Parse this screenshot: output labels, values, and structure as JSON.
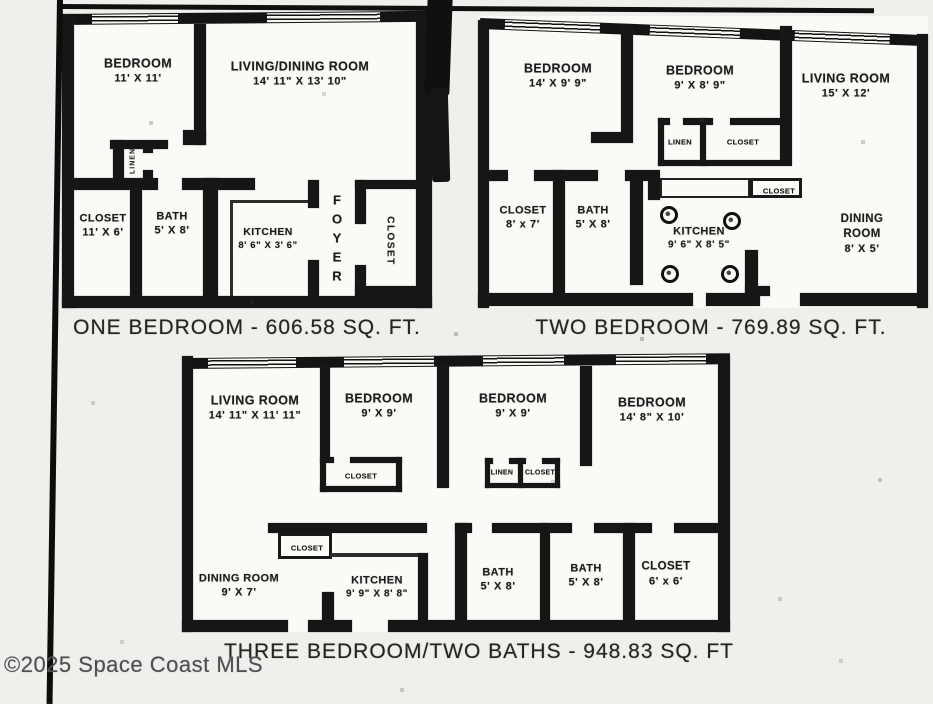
{
  "page": {
    "watermark": "©2025 Space Coast MLS",
    "paper_color": "#f0efeb",
    "ink_color": "#161616"
  },
  "one_bedroom": {
    "caption": "ONE BEDROOM - 606.58 SQ. FT.",
    "rooms": {
      "bedroom": {
        "name": "BEDROOM",
        "dims": "11' X 11'"
      },
      "living_dining": {
        "name": "LIVING/DINING ROOM",
        "dims": "14' 11\" X 13' 10\""
      },
      "linen": {
        "name": "LINEN"
      },
      "closet": {
        "name": "CLOSET",
        "dims": "11' X 6'"
      },
      "bath": {
        "name": "BATH",
        "dims": "5' X 8'"
      },
      "kitchen": {
        "name": "KITCHEN",
        "dims": "8' 6\" X 3' 6\""
      },
      "foyer": {
        "name": "FOYER"
      },
      "entry_closet": {
        "name": "CLOSET"
      }
    }
  },
  "two_bedroom": {
    "caption": "TWO BEDROOM - 769.89 SQ. FT.",
    "rooms": {
      "bedroom_1": {
        "name": "BEDROOM",
        "dims": "14' X 9' 9\""
      },
      "bedroom_2": {
        "name": "BEDROOM",
        "dims": "9' X 8' 9\""
      },
      "living_room": {
        "name": "LIVING ROOM",
        "dims": "15' X 12'"
      },
      "linen": {
        "name": "LINEN"
      },
      "hall_closet": {
        "name": "CLOSET"
      },
      "closet": {
        "name": "CLOSET",
        "dims": "8' x 7'"
      },
      "bath": {
        "name": "BATH",
        "dims": "5' X 8'"
      },
      "kitchen": {
        "name": "KITCHEN",
        "dims": "9' 6\" X 8' 5\""
      },
      "kitchen_closet": {
        "name": "CLOSET"
      },
      "dining_room": {
        "name": "DINING ROOM",
        "dims": "8' X 5'"
      }
    }
  },
  "three_bedroom": {
    "caption": "THREE BEDROOM/TWO BATHS - 948.83 SQ. FT",
    "rooms": {
      "living_room": {
        "name": "LIVING ROOM",
        "dims": "14' 11\" X 11' 11\""
      },
      "bedroom_1": {
        "name": "BEDROOM",
        "dims": "9' X 9'"
      },
      "bedroom_1_closet": {
        "name": "CLOSET"
      },
      "bedroom_2": {
        "name": "BEDROOM",
        "dims": "9' X 9'"
      },
      "linen": {
        "name": "LINEN"
      },
      "bedroom_2_closet": {
        "name": "CLOSET"
      },
      "bedroom_3": {
        "name": "BEDROOM",
        "dims": "14' 8\" X 10'"
      },
      "dining_room": {
        "name": "DINING ROOM",
        "dims": "9' X 7'"
      },
      "hall_closet": {
        "name": "CLOSET"
      },
      "kitchen": {
        "name": "KITCHEN",
        "dims": "9' 9\" X 8' 8\""
      },
      "bath_1": {
        "name": "BATH",
        "dims": "5' X 8'"
      },
      "bath_2": {
        "name": "BATH",
        "dims": "5' X 8'"
      },
      "closet": {
        "name": "CLOSET",
        "dims": "6' x 6'"
      }
    }
  }
}
